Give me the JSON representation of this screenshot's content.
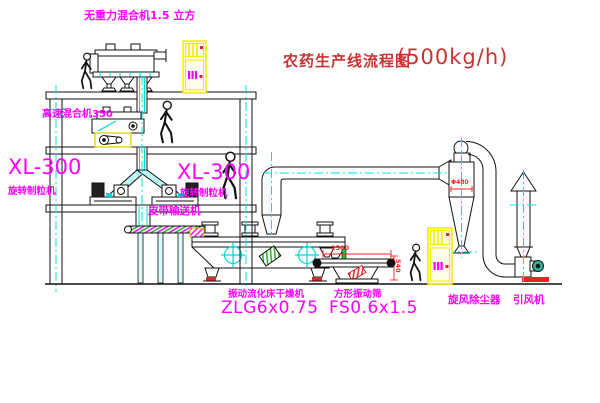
{
  "title": {
    "cn": "农药生产线流程图",
    "rate": "(500kg/h)"
  },
  "labels": {
    "gravity_mixer": "无重力混合机1.5 立方",
    "high_speed_mixer": "高速混合机350",
    "granulator_model_left": "XL-300",
    "granulator_name_left": "旋转制粒机",
    "granulator_model_mid": "XL-300",
    "granulator_name_mid": "旋转制粒机",
    "belt_conveyor": "皮带输送机",
    "dryer_name": "振动流化床干燥机",
    "dryer_model": "ZLG6x0.75",
    "screen_name": "方形振动筛",
    "screen_model": "FS0.6x1.5",
    "cyclone": "旋风除尘器",
    "fan": "引风机"
  },
  "dimensions": {
    "screen_length": "1500",
    "screen_height": "540",
    "cyclone_diameter": "Φ480"
  },
  "colors": {
    "label_magenta": "#ff00ff",
    "title_red": "#c83333",
    "dimension_red": "#ff2222",
    "centerline_cyan": "#00e0e0",
    "cabinet_yellow": "#f5e900",
    "line_black": "#111111",
    "status_red": "#ee2222",
    "hatch_green": "#22aa22"
  }
}
